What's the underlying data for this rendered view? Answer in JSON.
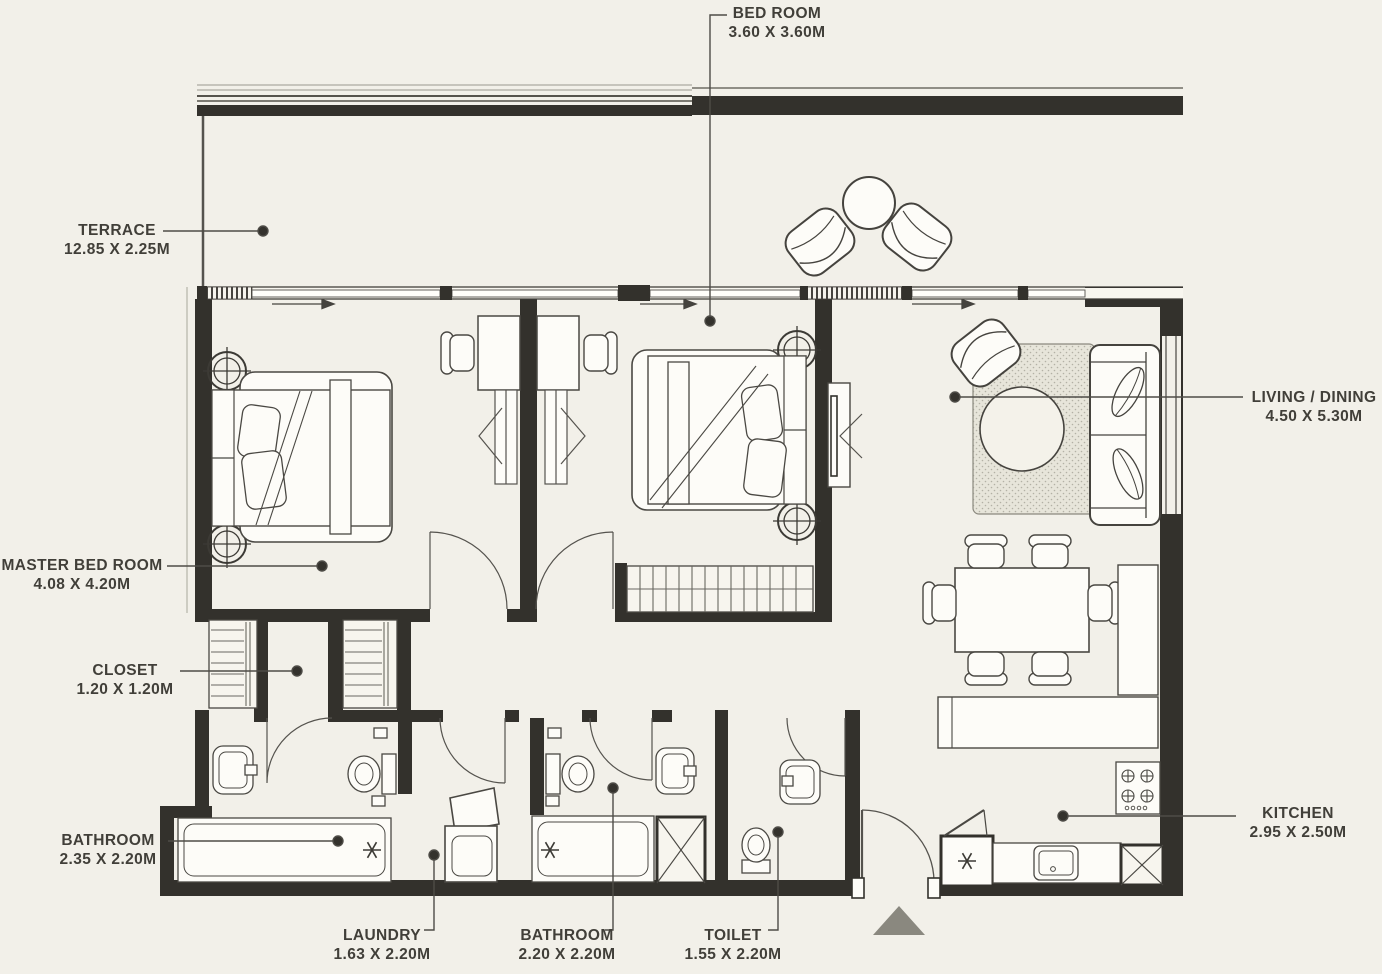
{
  "plan": {
    "type": "apartment-floor-plan",
    "rooms": [
      {
        "id": "bedroom",
        "name": "BED ROOM",
        "dims": "3.60 X 3.60M"
      },
      {
        "id": "terrace",
        "name": "TERRACE",
        "dims": "12.85 X 2.25M"
      },
      {
        "id": "living-dining",
        "name": "LIVING / DINING",
        "dims": "4.50 X 5.30M"
      },
      {
        "id": "master-bedroom",
        "name": "MASTER BED ROOM",
        "dims": "4.08 X 4.20M"
      },
      {
        "id": "closet",
        "name": "CLOSET",
        "dims": "1.20 X 1.20M"
      },
      {
        "id": "bathroom-1",
        "name": "BATHROOM",
        "dims": "2.35 X 2.20M"
      },
      {
        "id": "laundry",
        "name": "LAUNDRY",
        "dims": "1.63 X 2.20M"
      },
      {
        "id": "bathroom-2",
        "name": "BATHROOM",
        "dims": "2.20 X 2.20M"
      },
      {
        "id": "toilet",
        "name": "TOILET",
        "dims": "1.55 X 2.20M"
      },
      {
        "id": "kitchen",
        "name": "KITCHEN",
        "dims": "2.95 X 2.50M"
      }
    ],
    "colors": {
      "background": "#f2f0e9",
      "wall": "#33312c",
      "line": "#4e4c47",
      "furniture_fill": "#fdfcf8",
      "rug_fill": "#e7e5da",
      "entry_marker": "#8a887f"
    }
  }
}
